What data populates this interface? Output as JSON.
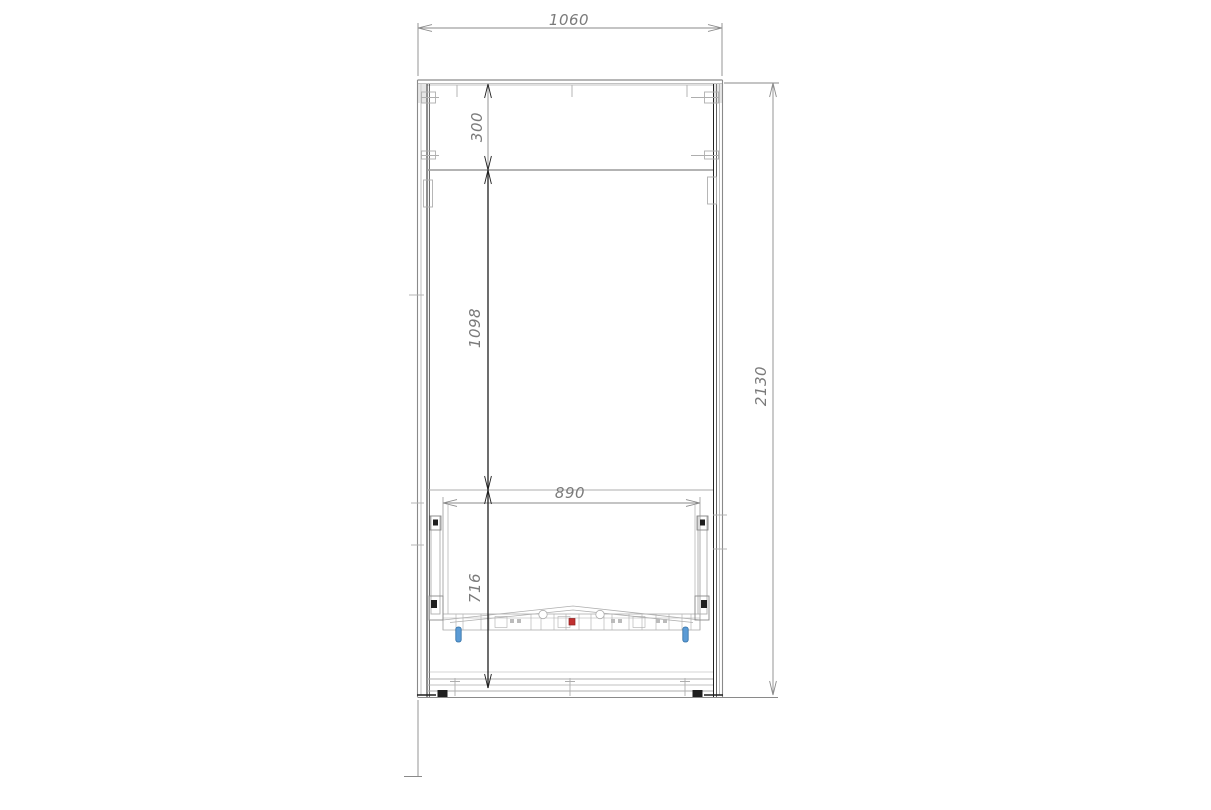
{
  "drawing": {
    "dimension_labels": {
      "overall_width": "1060",
      "overall_height": "2130",
      "top_section_height": "300",
      "middle_section_height": "1098",
      "inner_width": "890",
      "lower_section_height": "716"
    },
    "colors": {
      "line_light": "#aeaeae",
      "line_mid": "#8a8a8a",
      "line_dark": "#1f1f1f",
      "label_gray": "#7a7a7a",
      "marker_red": "#c03030",
      "marker_blue": "#5b9bd5",
      "background": "#ffffff"
    }
  }
}
